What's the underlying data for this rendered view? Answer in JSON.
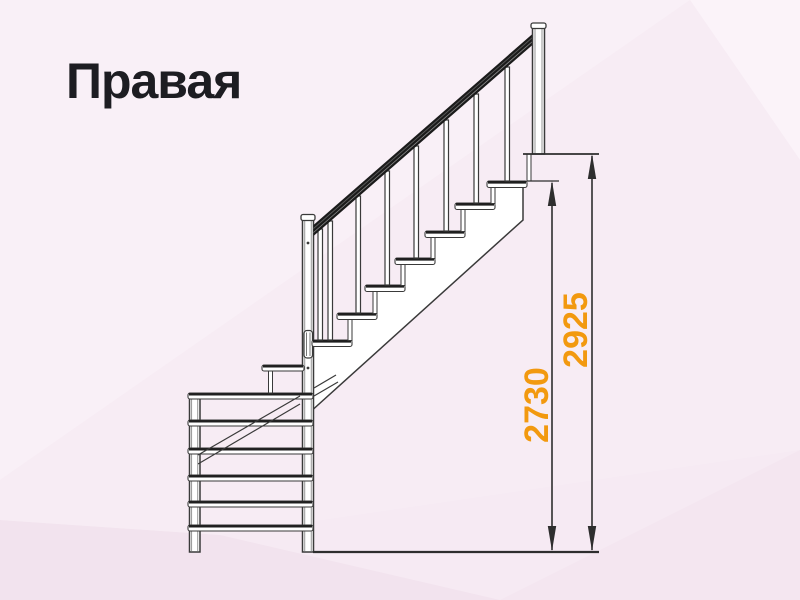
{
  "title": "Правая",
  "drawing": {
    "description": "L-shaped staircase, side elevation",
    "dimensions": {
      "height_to_top_step": "2730",
      "total_height": "2925"
    },
    "structure": {
      "lower_flight_visible_treads": 6,
      "winder_treads": 1,
      "upper_flight_treads": 7
    },
    "colors": {
      "background": "#f6eaf3",
      "line": "#3a3a3a",
      "handrail": "#1b1b1b",
      "dimension_text": "#f2990f",
      "title_text": "#1d1d22"
    }
  }
}
